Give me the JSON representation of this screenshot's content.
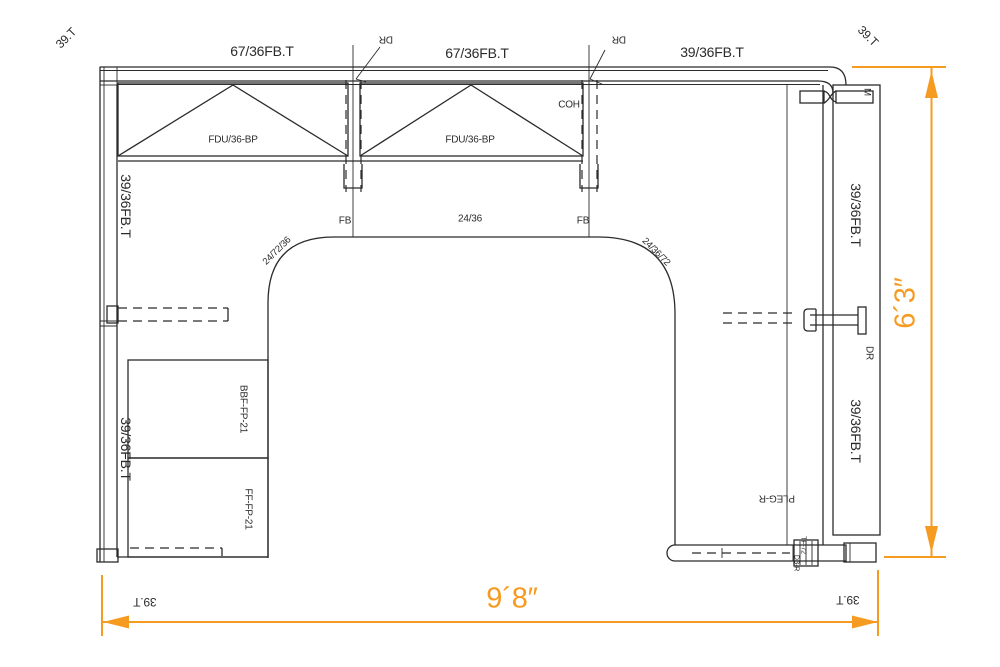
{
  "labels": {
    "tick_tl": "39.T",
    "panel_top_1": "67/36FB.T",
    "dr_top_1": "DR",
    "panel_top_2": "67/36FB.T",
    "dr_top_2": "DR",
    "panel_top_3": "39/36FB.T",
    "tick_tr": "39.T",
    "coh": "COH",
    "fdu_1": "FDU/36-BP",
    "fdu_2": "FDU/36-BP",
    "m_connector": "M",
    "panel_left_1": "39/36FB.T",
    "panel_left_2": "39/36FB.T",
    "panel_right_1": "39/36FB.T",
    "panel_right_2": "39/36FB.T",
    "dr_right": "DR",
    "fb_left": "FB",
    "bridge": "24/36",
    "fb_right": "FB",
    "corner_left": "24/72/36",
    "corner_right": "24/36/72",
    "ped_top": "BBF-FP-21",
    "ped_bottom": "FF-FP-21",
    "pleg": "PLEG-R",
    "tf": "TF-72",
    "db": "DB-R",
    "tick_bl": "39.T",
    "dim_width": "9´8″",
    "tick_br": "39.T",
    "dim_height": "6´3″"
  },
  "colors": {
    "line": "#2b2b2b",
    "dim": "#f59b22",
    "bg": "#ffffff"
  }
}
